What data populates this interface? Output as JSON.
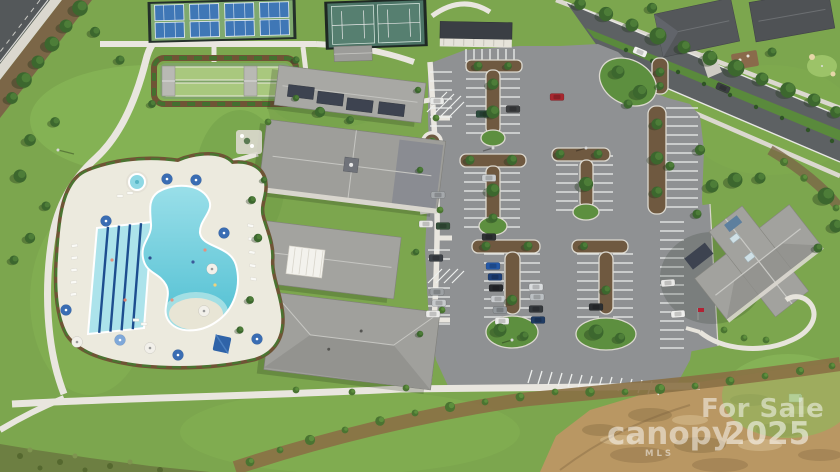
{
  "meta": {
    "type": "aerial-drone-photograph",
    "subject": "Master-planned community amenity center: clubhouse, resort pool, sport courts, parking lot",
    "time_of_day": "midday"
  },
  "watermark": {
    "line1": "For Sale",
    "brand": "canopy",
    "brand_sub": "MLS",
    "year": "2025",
    "color": "#ffffff",
    "opacity": 0.5
  },
  "features": {
    "pickleball": {
      "label": "Pickleball courts",
      "count": 8,
      "court_color": "#3F77B6",
      "apron_color": "#7FA96F"
    },
    "tennis": {
      "label": "Tennis courts",
      "count": 2,
      "surface_color": "#4B7365"
    },
    "bocce": {
      "label": "Bocce lanes",
      "count": 2,
      "lane_color": "#A9C87E"
    },
    "pool": {
      "label": "Resort-style swimming pool",
      "water_color": "#5FC8D8",
      "lap_lanes": 5,
      "has_spa": true,
      "umbrella_count": 12
    },
    "clubhouse": {
      "label": "Clubhouse complex",
      "roof_color": "#9E9E9B",
      "has_solar_panels": true
    },
    "amenity_building": {
      "label": "Secondary amenity building",
      "roof_color": "#A0A09D"
    },
    "parking": {
      "label": "Parking lot",
      "visible_vehicles": 28,
      "asphalt_color": "#8F9193"
    },
    "boulevard": {
      "label": "Divided boulevard with tree allee",
      "median_color": "#5A8A3C"
    },
    "homes": {
      "label": "Residential homes",
      "count": 2,
      "roof_color": "#54575A"
    },
    "trail": {
      "label": "Walking trail",
      "surface_color": "#E9E6DF"
    },
    "dirt": {
      "label": "Graded dirt / future development",
      "color": "#B99763"
    }
  },
  "palette": {
    "grass": "#7CA64E",
    "grass_light": "#8FBE5E",
    "tree": "#3C672E",
    "asphalt_road": "#5D6163",
    "asphalt_parking": "#8F9193",
    "concrete": "#E9E6DF",
    "curb": "#DCD9D0",
    "mulch": "#6F5940",
    "dirt": "#B99763",
    "pool_water": "#5FC8D8",
    "roof_gray": "#9E9E9B",
    "roof_dark": "#54575A",
    "solar_panel": "#3D4350",
    "umbrella_blue": "#3A6DB3",
    "car_red": "#A8272F"
  }
}
